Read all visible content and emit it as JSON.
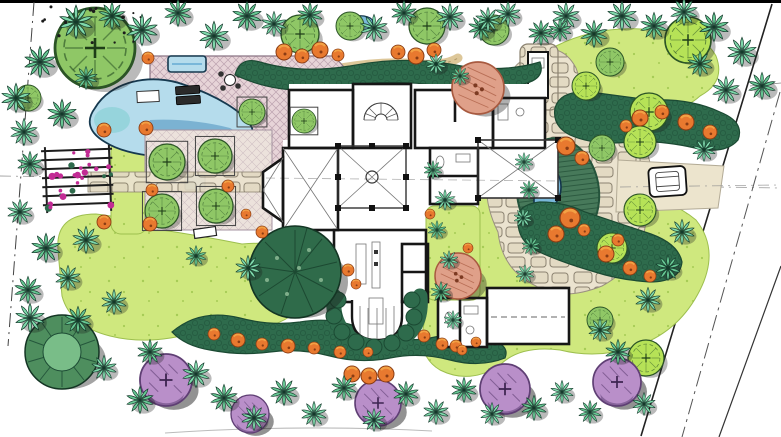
{
  "drawing": {
    "kind": "hand-rendered residential landscape master plan, top-down site view",
    "visible_text": "none"
  },
  "palette": {
    "paper": "#ffffff",
    "lawn": "#cfe87e",
    "lawnDot": "#a6cc55",
    "palm": "#7fd8ab",
    "palmAlt": "#67c793",
    "palmEdge": "#13392a",
    "canopy": "#8fc766",
    "canopyBright": "#b6e257",
    "canopyEdge": "#2b5426",
    "shrub": "#2e6b4c",
    "shrubEdge": "#1b4a33",
    "orange": "#e8792f",
    "orangeLight": "#f5ab4a",
    "orangeDark": "#8a3c14",
    "salmon": "#dfa089",
    "salmonEdge": "#a85a40",
    "purple": "#b98fc9",
    "purpleEdge": "#5f3f74",
    "poolLight": "#b5dcec",
    "poolMid": "#79b7d9",
    "poolDeep": "#4b90be",
    "aqua": "#8fd2d8",
    "deck": "#e7d4d8",
    "deckLine": "#ad91a1",
    "court": "#ece2dc",
    "courtLine": "#bca9b4",
    "stoneBg": "#ebe3cf",
    "stone": "#e3dac3",
    "stoneLine": "#8b8270",
    "tanPath": "#dbc493",
    "drive": "#ece4cd",
    "wall": "#161616",
    "thin": "#777777",
    "axis": "#8f8f8f",
    "magenta": "#c22b94",
    "island": "#47795a",
    "islandEdge": "#25543c",
    "shadow": "#1b1b1b"
  },
  "plan": {
    "palms": [
      [
        16,
        98,
        14,
        0
      ],
      [
        40,
        62,
        15,
        1
      ],
      [
        76,
        22,
        16,
        0
      ],
      [
        112,
        16,
        13,
        1
      ],
      [
        142,
        30,
        15,
        0
      ],
      [
        178,
        13,
        13,
        1
      ],
      [
        214,
        36,
        14,
        0
      ],
      [
        247,
        16,
        14,
        1
      ],
      [
        274,
        24,
        12,
        0
      ],
      [
        310,
        15,
        12,
        1
      ],
      [
        374,
        28,
        13,
        0
      ],
      [
        404,
        13,
        12,
        1
      ],
      [
        450,
        17,
        13,
        0
      ],
      [
        481,
        28,
        12,
        1
      ],
      [
        508,
        14,
        12,
        0
      ],
      [
        541,
        33,
        12,
        1
      ],
      [
        566,
        16,
        13,
        0
      ],
      [
        594,
        34,
        13,
        1
      ],
      [
        622,
        16,
        14,
        0
      ],
      [
        654,
        26,
        13,
        1
      ],
      [
        684,
        12,
        13,
        0
      ],
      [
        714,
        27,
        14,
        1
      ],
      [
        742,
        52,
        14,
        0
      ],
      [
        762,
        86,
        13,
        1
      ],
      [
        726,
        90,
        13,
        0
      ],
      [
        700,
        64,
        12,
        1
      ],
      [
        24,
        132,
        13,
        0
      ],
      [
        62,
        114,
        14,
        1
      ],
      [
        86,
        78,
        11,
        1
      ],
      [
        30,
        164,
        12,
        1
      ],
      [
        20,
        212,
        12,
        0
      ],
      [
        46,
        248,
        14,
        1
      ],
      [
        86,
        240,
        13,
        0
      ],
      [
        28,
        290,
        13,
        1
      ],
      [
        68,
        278,
        12,
        0
      ],
      [
        114,
        302,
        12,
        0
      ],
      [
        30,
        318,
        14,
        0
      ],
      [
        78,
        320,
        13,
        1
      ],
      [
        104,
        368,
        12,
        0
      ],
      [
        140,
        400,
        13,
        1
      ],
      [
        150,
        352,
        12,
        1
      ],
      [
        196,
        374,
        13,
        0
      ],
      [
        224,
        398,
        13,
        1
      ],
      [
        254,
        418,
        12,
        0
      ],
      [
        284,
        392,
        13,
        1
      ],
      [
        314,
        414,
        12,
        0
      ],
      [
        344,
        388,
        12,
        1
      ],
      [
        374,
        420,
        11,
        0
      ],
      [
        406,
        394,
        12,
        1
      ],
      [
        436,
        412,
        12,
        0
      ],
      [
        464,
        390,
        12,
        1
      ],
      [
        492,
        414,
        11,
        0
      ],
      [
        534,
        408,
        12,
        1
      ],
      [
        562,
        392,
        11,
        0
      ],
      [
        590,
        412,
        11,
        1
      ],
      [
        644,
        404,
        11,
        0
      ],
      [
        618,
        352,
        12,
        1
      ],
      [
        600,
        330,
        11,
        0
      ],
      [
        648,
        300,
        12,
        0
      ],
      [
        668,
        268,
        12,
        1
      ],
      [
        682,
        232,
        12,
        0
      ],
      [
        704,
        150,
        11,
        0
      ],
      [
        524,
        162,
        9,
        0
      ],
      [
        529,
        190,
        9,
        1
      ],
      [
        523,
        218,
        9,
        0
      ],
      [
        531,
        246,
        9,
        1
      ],
      [
        525,
        274,
        9,
        0
      ],
      [
        433,
        170,
        9,
        1
      ],
      [
        445,
        200,
        10,
        0
      ],
      [
        437,
        230,
        9,
        1
      ],
      [
        449,
        260,
        9,
        0
      ],
      [
        441,
        292,
        10,
        1
      ],
      [
        453,
        320,
        9,
        0
      ],
      [
        436,
        64,
        10,
        0
      ],
      [
        460,
        76,
        9,
        1
      ],
      [
        488,
        20,
        12,
        0
      ],
      [
        560,
        30,
        11,
        1
      ],
      [
        248,
        268,
        12,
        0
      ],
      [
        196,
        256,
        10,
        1
      ]
    ],
    "canopy_trees": [
      [
        95,
        48,
        40,
        0
      ],
      [
        28,
        98,
        13,
        0
      ],
      [
        300,
        34,
        19,
        0
      ],
      [
        350,
        26,
        14,
        0
      ],
      [
        427,
        26,
        18,
        0
      ],
      [
        494,
        30,
        15,
        0
      ],
      [
        688,
        40,
        23,
        1
      ],
      [
        649,
        112,
        19,
        1
      ],
      [
        586,
        86,
        14,
        1
      ],
      [
        610,
        62,
        14,
        0
      ],
      [
        640,
        142,
        16,
        1
      ],
      [
        602,
        148,
        13,
        0
      ],
      [
        640,
        210,
        16,
        1
      ],
      [
        612,
        248,
        15,
        1
      ],
      [
        646,
        358,
        18,
        1
      ],
      [
        600,
        320,
        13,
        0
      ]
    ],
    "planter_trees": [
      [
        167,
        162,
        18
      ],
      [
        215,
        156,
        17
      ],
      [
        162,
        211,
        17
      ],
      [
        216,
        206,
        17
      ],
      [
        252,
        112,
        13
      ],
      [
        304,
        121,
        12
      ]
    ],
    "purple_trees": [
      [
        166,
        380,
        26
      ],
      [
        250,
        414,
        19
      ],
      [
        378,
        403,
        23
      ],
      [
        505,
        389,
        25
      ],
      [
        617,
        382,
        24
      ]
    ],
    "salmon_trees": [
      [
        478,
        88,
        26
      ],
      [
        458,
        276,
        23
      ]
    ],
    "orange_shrubs": [
      [
        148,
        58,
        6
      ],
      [
        284,
        52,
        8
      ],
      [
        302,
        56,
        7
      ],
      [
        320,
        50,
        8
      ],
      [
        338,
        55,
        6
      ],
      [
        398,
        52,
        7
      ],
      [
        416,
        56,
        8
      ],
      [
        434,
        50,
        7
      ],
      [
        640,
        118,
        8
      ],
      [
        662,
        112,
        7
      ],
      [
        686,
        122,
        8
      ],
      [
        710,
        132,
        7
      ],
      [
        626,
        126,
        6
      ],
      [
        566,
        146,
        9
      ],
      [
        582,
        158,
        7
      ],
      [
        570,
        218,
        10
      ],
      [
        556,
        234,
        8
      ],
      [
        584,
        230,
        6
      ],
      [
        606,
        254,
        8
      ],
      [
        630,
        268,
        7
      ],
      [
        618,
        240,
        6
      ],
      [
        650,
        276,
        6
      ],
      [
        214,
        334,
        6
      ],
      [
        238,
        340,
        7
      ],
      [
        262,
        344,
        6
      ],
      [
        288,
        346,
        7
      ],
      [
        314,
        348,
        6
      ],
      [
        340,
        352,
        6
      ],
      [
        368,
        352,
        5
      ],
      [
        456,
        346,
        6
      ],
      [
        476,
        342,
        5
      ],
      [
        104,
        130,
        7
      ],
      [
        146,
        128,
        7
      ],
      [
        104,
        222,
        7
      ],
      [
        150,
        224,
        7
      ],
      [
        152,
        190,
        6
      ],
      [
        228,
        186,
        6
      ],
      [
        246,
        214,
        5
      ],
      [
        262,
        232,
        6
      ],
      [
        348,
        270,
        6
      ],
      [
        356,
        284,
        5
      ],
      [
        424,
        336,
        6
      ],
      [
        442,
        344,
        6
      ],
      [
        462,
        350,
        5
      ],
      [
        430,
        214,
        5
      ],
      [
        468,
        248,
        5
      ],
      [
        352,
        374,
        8
      ],
      [
        369,
        376,
        8
      ],
      [
        386,
        374,
        8
      ]
    ],
    "site_features": [
      "swimming-pool",
      "spa",
      "pool-deck",
      "lounge-chairs",
      "patio-table",
      "trellis-arbor",
      "formal-parterre-garden",
      "parterre-water-feature",
      "garden-bench",
      "entry-walk",
      "house-floor-plan",
      "rotunda-hall",
      "circular-stair",
      "kitchen-island",
      "bay-window",
      "garage",
      "internal-garden-court",
      "east-loggia",
      "stone-motor-court",
      "fountain",
      "planted-island",
      "outdoor-fireplace",
      "driveway",
      "car",
      "property-lines",
      "road-edge",
      "lawn",
      "shrub-borders",
      "small-pond",
      "hedge-arc"
    ]
  }
}
